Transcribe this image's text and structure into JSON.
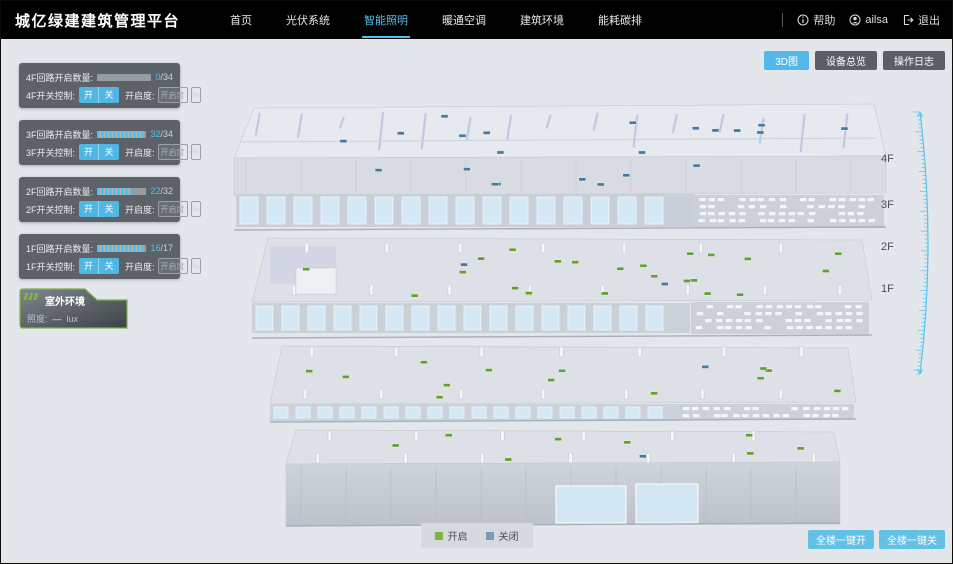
{
  "header": {
    "title": "城亿绿建建筑管理平台",
    "nav": [
      {
        "label": "首页"
      },
      {
        "label": "光伏系统"
      },
      {
        "label": "智能照明"
      },
      {
        "label": "暖通空调"
      },
      {
        "label": "建筑环境"
      },
      {
        "label": "能耗碳排"
      }
    ],
    "help_label": "帮助",
    "username": "ailsa",
    "logout_label": "退出"
  },
  "view_buttons": [
    {
      "label": "3D图"
    },
    {
      "label": "设备总览"
    },
    {
      "label": "操作日志"
    }
  ],
  "floor_panels": [
    {
      "count_label": "4F回路开启数量:",
      "open": 0,
      "total": 34,
      "total_text": "/34",
      "control_label": "4F开关控制:",
      "on_label": "开",
      "off_label": "关",
      "dim_label": "开启度:",
      "dim_placeholder": "开启度",
      "percent_label": "%"
    },
    {
      "count_label": "3F回路开启数量:",
      "open": 32,
      "total": 34,
      "total_text": "/34",
      "control_label": "3F开关控制:",
      "on_label": "开",
      "off_label": "关",
      "dim_label": "开启度:",
      "dim_placeholder": "开启度",
      "percent_label": "%"
    },
    {
      "count_label": "2F回路开启数量:",
      "open": 22,
      "total": 32,
      "total_text": "/32",
      "control_label": "2F开关控制:",
      "on_label": "开",
      "off_label": "关",
      "dim_label": "开启度:",
      "dim_placeholder": "开启度",
      "percent_label": "%"
    },
    {
      "count_label": "1F回路开启数量:",
      "open": 16,
      "total": 17,
      "total_text": "/17",
      "control_label": "1F开关控制:",
      "on_label": "开",
      "off_label": "关",
      "dim_label": "开启度:",
      "dim_placeholder": "开启度",
      "percent_label": "%"
    }
  ],
  "outdoor_panel": {
    "title": "室外环境",
    "illuminance_label": "照度:",
    "illuminance_value": "—",
    "illuminance_unit": "lux"
  },
  "floor_scale": {
    "labels": [
      "4F",
      "3F",
      "2F",
      "1F"
    ]
  },
  "legend": [
    {
      "label": "开启",
      "color": "#7cb246"
    },
    {
      "label": "关闭",
      "color": "#7e9cba"
    }
  ],
  "bulk_buttons": [
    {
      "label": "全楼一键开"
    },
    {
      "label": "全楼一键关"
    }
  ],
  "colors": {
    "accent": "#4fb7e3",
    "marker_on": "#5fa02e",
    "marker_off": "#44789c",
    "ruler": "#58c2ea"
  }
}
